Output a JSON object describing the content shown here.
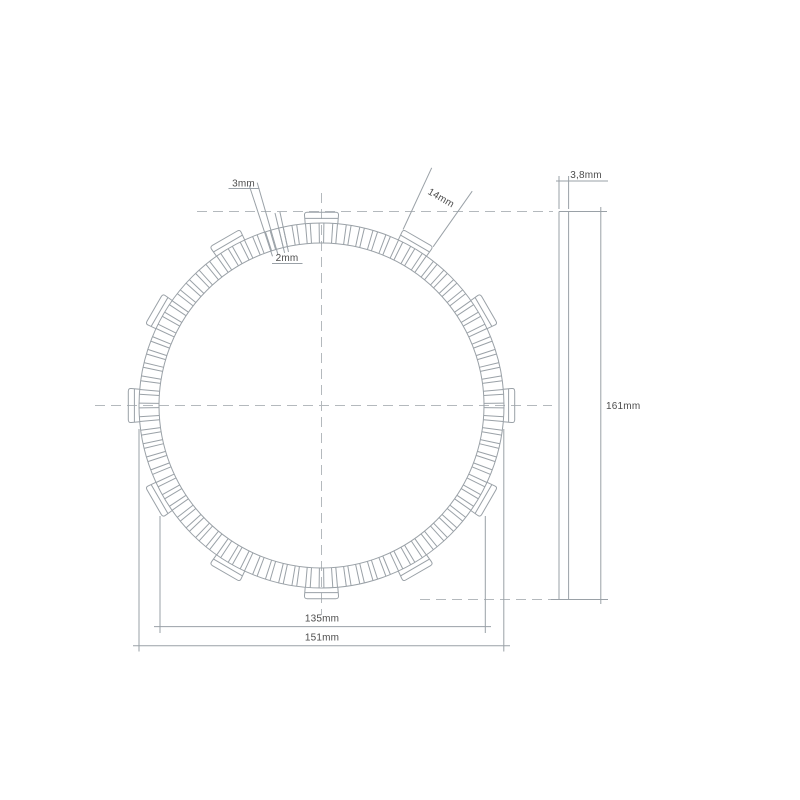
{
  "title": "Clutch friction plate technical drawing",
  "dimensions": {
    "groove_width_a": "3mm",
    "groove_width_b": "2mm",
    "tab_width": "14mm",
    "thickness": "3,8mm",
    "overall_diameter": "161mm",
    "friction_inner_diameter": "135mm",
    "friction_outer_diameter": "151mm"
  },
  "drawing": {
    "colors": {
      "line": "#9aa1a7",
      "centerline": "#b4b9bd",
      "text": "#4d4d4d",
      "background": "#ffffff"
    },
    "front_view": {
      "cx": 321.5,
      "cy": 405.5,
      "r_inner": 162.5,
      "r_outer": 182.5,
      "r_tab": 194,
      "r_tab_step": 187.8,
      "tab_count": 12,
      "tab_half_angle_deg": 5.12,
      "pad_segments": 84,
      "groove_half_angle_deg": 0.75
    },
    "side_view": {
      "x1": 559,
      "x2": 568.6,
      "y1": 211.5,
      "y2": 599.5
    }
  }
}
